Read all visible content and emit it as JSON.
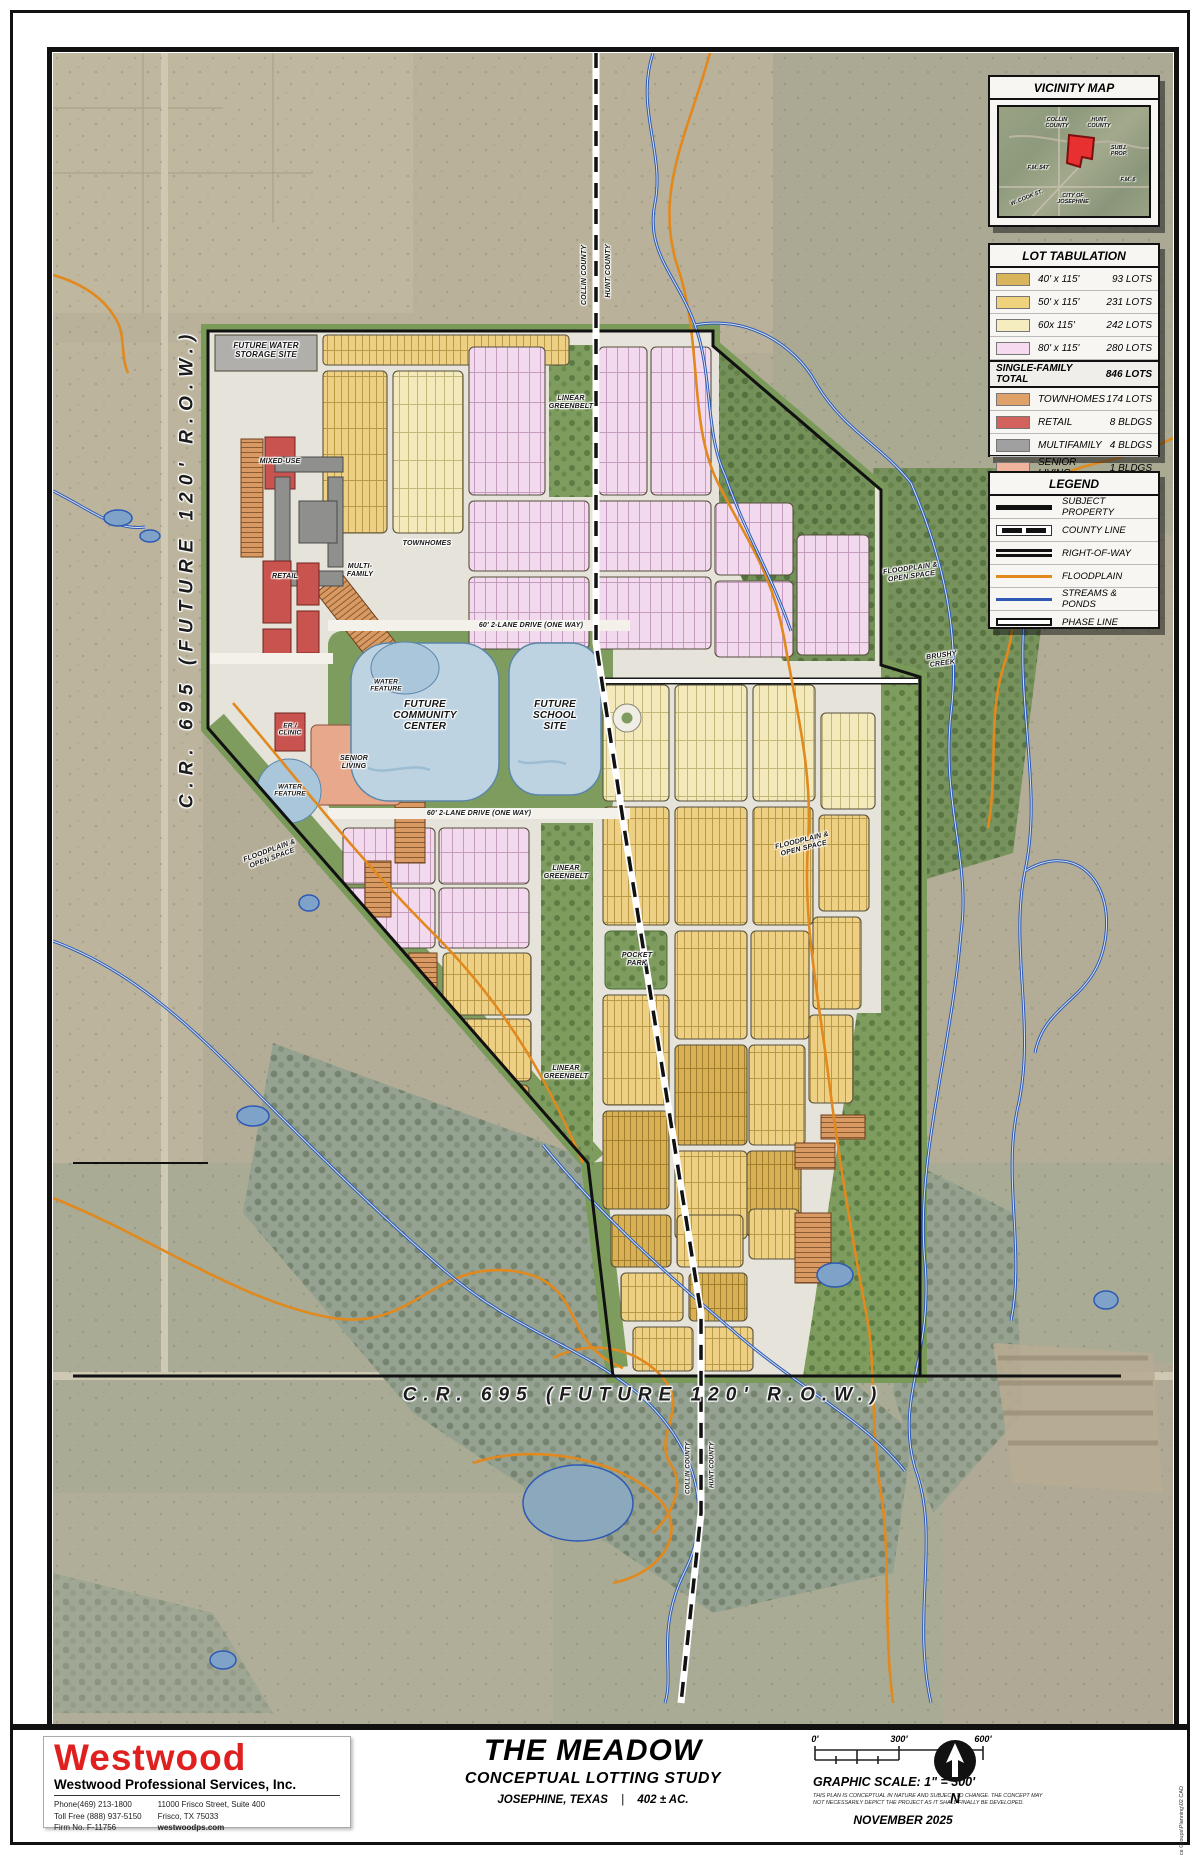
{
  "vicinity": {
    "title": "VICINITY MAP",
    "subj_prop": "SUBJ. PROP.",
    "fm547": "F.M. 547",
    "w_cook": "W. COOK ST.",
    "city": "CITY OF JOSEPHINE",
    "fm6": "F.M. 6"
  },
  "map_labels": {
    "county_collin": "COLLIN COUNTY",
    "county_hunt": "HUNT COUNTY",
    "cr695": "C.R. 695 (FUTURE 120' R.O.W.)",
    "future_water_storage": "FUTURE WATER STORAGE SITE",
    "mixed_use": "MIXED-USE",
    "townhomes": "TOWNHOMES",
    "multi_family": "MULTI-FAMILY",
    "retail": "RETAIL",
    "er_clinic": "ER / CLINIC",
    "senior_living": "SENIOR LIVING",
    "water_feature": "WATER FEATURE",
    "linear_greenbelt": "LINEAR GREENBELT",
    "floodplain_open": "FLOODPLAIN & OPEN SPACE",
    "brushy_creek": "BRUSHY CREEK",
    "pocket_park": "POCKET PARK",
    "drive": "60' 2-LANE DRIVE (ONE WAY)",
    "community_center": "FUTURE COMMUNITY CENTER",
    "school_site": "FUTURE SCHOOL SITE"
  },
  "lot_tabulation": {
    "title": "LOT TABULATION",
    "rows": [
      {
        "label": "40' x 115'",
        "value": "93 LOTS",
        "color": "#d8b45a"
      },
      {
        "label": "50' x 115'",
        "value": "231 LOTS",
        "color": "#f0d27c"
      },
      {
        "label": "60x 115'",
        "value": "242 LOTS",
        "color": "#f5ecc0"
      },
      {
        "label": "80' x 115'",
        "value": "280 LOTS",
        "color": "#f6daf0"
      }
    ],
    "total_label": "SINGLE-FAMILY TOTAL",
    "total_value": "846 LOTS",
    "other_rows": [
      {
        "label": "TOWNHOMES",
        "value": "174 LOTS",
        "color": "#e0a06a"
      },
      {
        "label": "RETAIL",
        "value": "8 BLDGS",
        "color": "#d4625c"
      },
      {
        "label": "MULTIFAMILY",
        "value": "4 BLDGS",
        "color": "#a0a0a0"
      },
      {
        "label": "SENIOR LIVING",
        "value": "1 BLDGS",
        "color": "#f0b49c"
      }
    ]
  },
  "legend": {
    "title": "LEGEND",
    "items": [
      "SUBJECT PROPERTY",
      "COUNTY LINE",
      "RIGHT-OF-WAY",
      "FLOODPLAIN",
      "STREAMS & PONDS",
      "PHASE LINE"
    ]
  },
  "title_block": {
    "company": "Westwood",
    "company_full": "Westwood Professional Services, Inc.",
    "phone": "Phone(469) 213-1800",
    "toll_free": "Toll Free (888) 937-5150",
    "firm": "Firm No. F-11756",
    "address1": "11000 Frisco Street, Suite 400",
    "address2": "Frisco, TX 75033",
    "website": "westwoodps.com",
    "project": "THE MEADOW",
    "subtitle": "CONCEPTUAL LOTTING STUDY",
    "location": "JOSEPHINE, TEXAS",
    "divider": "|",
    "acreage": "402 ± AC.",
    "scale_ticks": [
      "0'",
      "300'",
      "600'"
    ],
    "scale_title": "GRAPHIC SCALE: 1\" = 300'",
    "disclaimer1": "THIS PLAN IS CONCEPTUAL IN NATURE AND SUBJECT TO CHANGE. THE CONCEPT MAY",
    "disclaimer2": "NOT NECESSARILY DEPICT THE PROJECT AS IT SHALL FINALLY BE DEVELOPED.",
    "date": "NOVEMBER 2025",
    "north": "N",
    "file_path": "N:0050873.0045 Service Groups\\Planning\\02 CAD"
  },
  "colors": {
    "brand_red": "#e01f1f",
    "floodplain": "#e2891e",
    "stream": "#2d59b5",
    "lot40": "#d8b45a",
    "lot50": "#f0d27c",
    "lot60": "#f5ecc0",
    "lot80": "#f6daf0",
    "townhome": "#e0a06a",
    "retail": "#d4625c",
    "multifamily": "#a0a0a0",
    "senior": "#f0b49c",
    "open_space": "#7e9c5e"
  }
}
